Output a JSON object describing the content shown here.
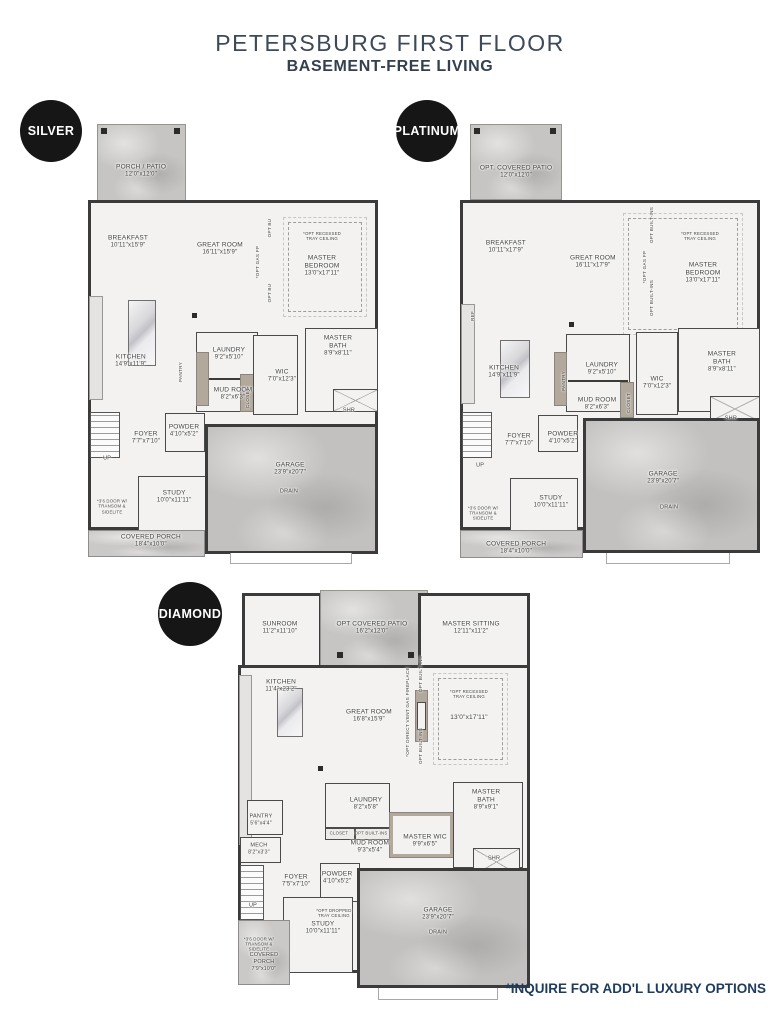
{
  "title": "PETERSBURG FIRST FLOOR",
  "subtitle": "BASEMENT-FREE LIVING",
  "footnote": "*INQUIRE FOR ADD'L LUXURY OPTIONS",
  "colors": {
    "badge": "#161616",
    "title": "#3d4a58",
    "footnote": "#1d3c5e",
    "concrete": "#c7c5c3",
    "taupe": "#b2a89b"
  },
  "plans": [
    {
      "id": "silver",
      "badge": "SILVER",
      "labels": [
        {
          "t": "PORCH / PATIO",
          "d": "12'0\"x12'0\"",
          "x": 18.3,
          "y": 10.5
        },
        {
          "t": "BREAKFAST",
          "d": "10'11\"x15'9\"",
          "x": 13.8,
          "y": 26.5
        },
        {
          "t": "GREAT ROOM",
          "d": "16'11\"x15'9\"",
          "x": 45.5,
          "y": 28.0
        },
        {
          "t": "*OPT RECESSED\nTRAY CEILING",
          "x": 80.7,
          "y": 25.1,
          "cls": "tiny"
        },
        {
          "t": "MASTER BEDROOM",
          "d": "13'0\"x17'11\"",
          "x": 80.7,
          "y": 31.8
        },
        {
          "t": "*OPT GAS FP",
          "x": 58.6,
          "y": 30.9,
          "rot": true
        },
        {
          "t": "OPT BU",
          "x": 62.8,
          "y": 23.3,
          "rot": true
        },
        {
          "t": "OPT BU",
          "x": 62.8,
          "y": 37.9,
          "rot": true
        },
        {
          "t": "KITCHEN",
          "d": "14'9\"x11'9\"",
          "x": 14.8,
          "y": 53.1
        },
        {
          "t": "LAUNDRY",
          "d": "9'2\"x5'10\"",
          "x": 48.6,
          "y": 51.6
        },
        {
          "t": "PANTRY",
          "x": 32.1,
          "y": 55.6,
          "rot": true
        },
        {
          "t": "MUD ROOM",
          "d": "8'2\"x6'3\"",
          "x": 50.0,
          "y": 60.5
        },
        {
          "t": "CLOSET",
          "x": 55.2,
          "y": 61.4,
          "rot": true
        },
        {
          "t": "WIC",
          "d": "7'0\"x12'3\"",
          "x": 66.9,
          "y": 56.5
        },
        {
          "t": "MASTER\nBATH",
          "d": "8'9\"x8'11\"",
          "x": 86.2,
          "y": 49.8
        },
        {
          "t": "SHR",
          "x": 90.0,
          "y": 64.3,
          "cls": "small"
        },
        {
          "t": "FOYER",
          "d": "7'7\"x7'10\"",
          "x": 20.0,
          "y": 70.4
        },
        {
          "t": "POWDER",
          "d": "4'10\"x5'2\"",
          "x": 33.1,
          "y": 68.8
        },
        {
          "t": "UP",
          "x": 6.6,
          "y": 75.1,
          "cls": "small"
        },
        {
          "t": "*3'6 DOOR W/\nTRANSOM &\nSIDELITE",
          "x": 8.3,
          "y": 85.7,
          "cls": "tiny"
        },
        {
          "t": "STUDY",
          "d": "10'0\"x11'11\"",
          "x": 29.7,
          "y": 83.6
        },
        {
          "t": "GARAGE",
          "d": "23'9\"x20'7\"",
          "x": 69.7,
          "y": 77.4
        },
        {
          "t": "DRAIN",
          "x": 69.3,
          "y": 82.5,
          "cls": "small"
        },
        {
          "t": "COVERED PORCH",
          "d": "18'4\"x10'0\"",
          "x": 21.7,
          "y": 93.5
        }
      ]
    },
    {
      "id": "platinum",
      "badge": "PLATINUM",
      "labels": [
        {
          "t": "OPT. COVERED PATIO",
          "d": "12'0\"x12'0\"",
          "x": 18.7,
          "y": 10.7
        },
        {
          "t": "BREAKFAST",
          "d": "10'11\"x17'9\"",
          "x": 15.3,
          "y": 27.3
        },
        {
          "t": "GREAT ROOM",
          "d": "16'11\"x17'9\"",
          "x": 44.3,
          "y": 30.7
        },
        {
          "t": "*OPT RECESSED\nTRAY CEILING",
          "x": 80.0,
          "y": 24.9,
          "cls": "tiny"
        },
        {
          "t": "MASTER\nBEDROOM",
          "d": "13'0\"x17'11\"",
          "x": 81.0,
          "y": 33.1
        },
        {
          "t": "*OPT GAS FP",
          "x": 61.7,
          "y": 31.8,
          "rot": true
        },
        {
          "t": "OPT BUILT-INS",
          "x": 64.0,
          "y": 22.4,
          "rot": true
        },
        {
          "t": "OPT BUILT-INS",
          "x": 64.0,
          "y": 38.7,
          "rot": true
        },
        {
          "t": "REF",
          "x": 4.3,
          "y": 42.7,
          "rot": true
        },
        {
          "t": "KITCHEN",
          "d": "14'9\"x11'9\"",
          "x": 14.7,
          "y": 55.1
        },
        {
          "t": "LAUNDRY",
          "d": "9'2\"x5'10\"",
          "x": 47.3,
          "y": 54.4
        },
        {
          "t": "PANTRY",
          "x": 34.7,
          "y": 57.1,
          "rot": true
        },
        {
          "t": "MUD ROOM",
          "d": "8'2\"x6'3\"",
          "x": 45.7,
          "y": 62.2
        },
        {
          "t": "CLOSET",
          "x": 56.3,
          "y": 62.0,
          "rot": true
        },
        {
          "t": "WIC",
          "d": "7'0\"x12'3\"",
          "x": 65.7,
          "y": 57.6
        },
        {
          "t": "MASTER\nBATH",
          "d": "8'9\"x8'11\"",
          "x": 87.3,
          "y": 52.9
        },
        {
          "t": "SHR",
          "x": 90.3,
          "y": 65.6,
          "cls": "small"
        },
        {
          "t": "POWDER",
          "d": "4'10\"x5'2\"",
          "x": 34.3,
          "y": 69.8
        },
        {
          "t": "FOYER",
          "d": "7'7\"x7'10\"",
          "x": 19.7,
          "y": 70.2
        },
        {
          "t": "UP",
          "x": 6.7,
          "y": 76.0,
          "cls": "small"
        },
        {
          "t": "*3'6 DOOR W/\nTRANSOM &\nSIDELITE",
          "x": 7.7,
          "y": 86.4,
          "cls": "tiny"
        },
        {
          "t": "STUDY",
          "d": "10'0\"x11'11\"",
          "x": 30.3,
          "y": 84.0
        },
        {
          "t": "GARAGE",
          "d": "23'9\"x20'7\"",
          "x": 67.7,
          "y": 78.7
        },
        {
          "t": "DRAIN",
          "x": 69.7,
          "y": 85.3,
          "cls": "small"
        },
        {
          "t": "COVERED PORCH",
          "d": "18'4\"x10'0\"",
          "x": 18.7,
          "y": 94.2
        }
      ]
    },
    {
      "id": "diamond",
      "badge": "DIAMOND",
      "labels": [
        {
          "t": "SUNROOM",
          "d": "11'2\"x11'10\"",
          "x": 14.2,
          "y": 9.2
        },
        {
          "t": "OPT COVERED PATIO",
          "d": "16'2\"x12'0\"",
          "x": 45.4,
          "y": 9.2
        },
        {
          "t": "MASTER SITTING",
          "d": "12'11\"x11'2\"",
          "x": 79.0,
          "y": 9.2
        },
        {
          "t": "KITCHEN",
          "d": "11'4\"x23'2\"",
          "x": 14.6,
          "y": 23.3
        },
        {
          "t": "GREAT ROOM",
          "d": "16'8\"x15'9\"",
          "x": 44.4,
          "y": 30.6
        },
        {
          "t": "*OPT RECESSED\nTRAY CEILING",
          "x": 78.3,
          "y": 25.2,
          "cls": "tiny"
        },
        {
          "t": "13'0\"x17'11\"",
          "x": 78.3,
          "y": 31.1
        },
        {
          "t": "*OPT DIRECT VENT GAS FIREPLACE",
          "x": 57.6,
          "y": 29.6,
          "rot": true
        },
        {
          "t": "OPT BUILT-INS",
          "x": 62.0,
          "y": 20.4,
          "rot": true
        },
        {
          "t": "OPT BUILT-INS",
          "x": 62.0,
          "y": 37.9,
          "rot": true
        },
        {
          "t": "PANTRY",
          "d": "5'6\"x4'4\"",
          "x": 7.8,
          "y": 55.8,
          "cls": "small"
        },
        {
          "t": "LAUNDRY",
          "d": "8'2\"x5'8\"",
          "x": 43.4,
          "y": 51.9
        },
        {
          "t": "CLOSET",
          "x": 34.2,
          "y": 59.0,
          "cls": "tiny"
        },
        {
          "t": "OPT BUILT-INS",
          "x": 45.1,
          "y": 59.0,
          "cls": "tiny"
        },
        {
          "t": "MUD ROOM",
          "d": "9'3\"x5'4\"",
          "x": 44.7,
          "y": 62.4
        },
        {
          "t": "MASTER WIC",
          "d": "9'9\"x6'5\"",
          "x": 63.4,
          "y": 60.9
        },
        {
          "t": "MASTER\nBATH",
          "d": "8'9\"x9'1\"",
          "x": 84.1,
          "y": 51.0
        },
        {
          "t": "SHR",
          "x": 86.8,
          "y": 65.3,
          "cls": "small"
        },
        {
          "t": "MECH",
          "d": "8'2\"x3'3\"",
          "x": 7.1,
          "y": 62.9,
          "cls": "small"
        },
        {
          "t": "FOYER",
          "d": "7'5\"x7'10\"",
          "x": 19.7,
          "y": 70.6
        },
        {
          "t": "POWDER",
          "d": "4'10\"x5'2\"",
          "x": 33.6,
          "y": 69.9
        },
        {
          "t": "UP",
          "x": 5.1,
          "y": 76.7,
          "cls": "small"
        },
        {
          "t": "*OPT DROPPED\nTRAY CEILING",
          "x": 32.5,
          "y": 78.4,
          "cls": "tiny"
        },
        {
          "t": "STUDY",
          "d": "10'0\"x11'11\"",
          "x": 28.8,
          "y": 82.0
        },
        {
          "t": "GARAGE",
          "d": "23'9\"x20'7\"",
          "x": 67.8,
          "y": 78.6
        },
        {
          "t": "DRAIN",
          "x": 67.8,
          "y": 83.3,
          "cls": "small"
        },
        {
          "t": "*3'6 DOOR W/\nTRANSOM &\nSIDELITE",
          "x": 7.1,
          "y": 85.9,
          "cls": "tiny"
        },
        {
          "t": "COVERED\nPORCH",
          "d": "7'9\"x10'0\"",
          "x": 8.8,
          "y": 90.3,
          "cls": "small"
        }
      ]
    }
  ]
}
